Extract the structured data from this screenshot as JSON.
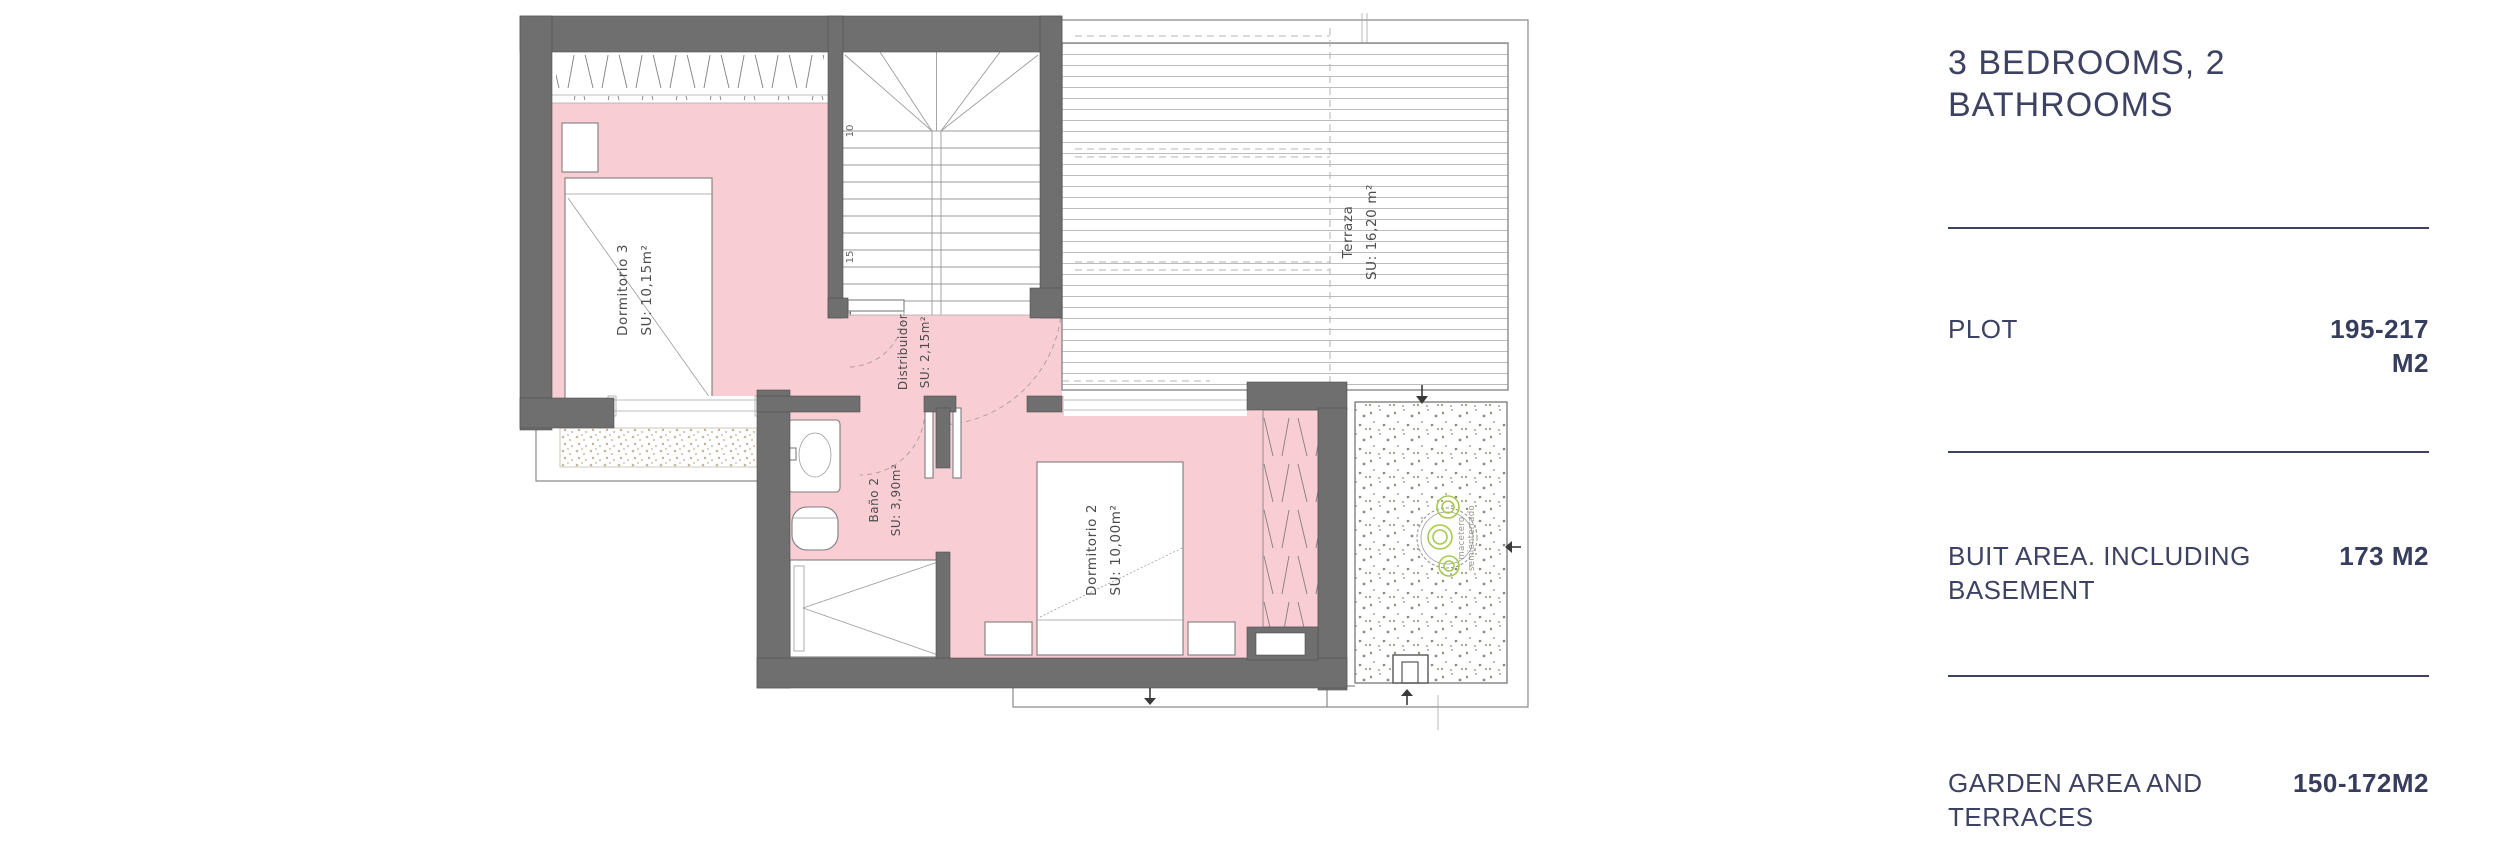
{
  "panel": {
    "title": "3 BEDROOMS, 2 BATHROOMS",
    "rows": [
      {
        "label": "PLOT",
        "value": "195-217 M2"
      },
      {
        "label": "BUIT AREA. INCLUDING BASEMENT",
        "value": "173 M2"
      },
      {
        "label": "GARDEN AREA AND TERRACES",
        "value": "150-172M2"
      }
    ]
  },
  "plan": {
    "rooms": {
      "dormitorio3": {
        "name": "Dormitorio 3",
        "area": "SU: 10,15m²"
      },
      "dormitorio2": {
        "name": "Dormitorio 2",
        "area": "SU: 10,00m²"
      },
      "bano2": {
        "name": "Baño 2",
        "area": "SU: 3,90m²"
      },
      "distribuidor": {
        "name": "Distribuidor",
        "area": "SU: 2,15m²"
      },
      "terraza": {
        "name": "Terraza",
        "area": "SU: 16,20 m²"
      }
    },
    "stair_numbers": {
      "n10": "10",
      "n15": "15",
      "n17": "17"
    },
    "planter_note_line1": "macetero",
    "planter_note_line2": "semienterrado",
    "colors": {
      "wall": "#6f6f6f",
      "room_fill": "#f8cdd3",
      "plan_line": "#8a8a8a",
      "label_text": "#4d4d4d",
      "plant_green": "#a6c94e",
      "panel_navy": "#3d4262"
    }
  }
}
